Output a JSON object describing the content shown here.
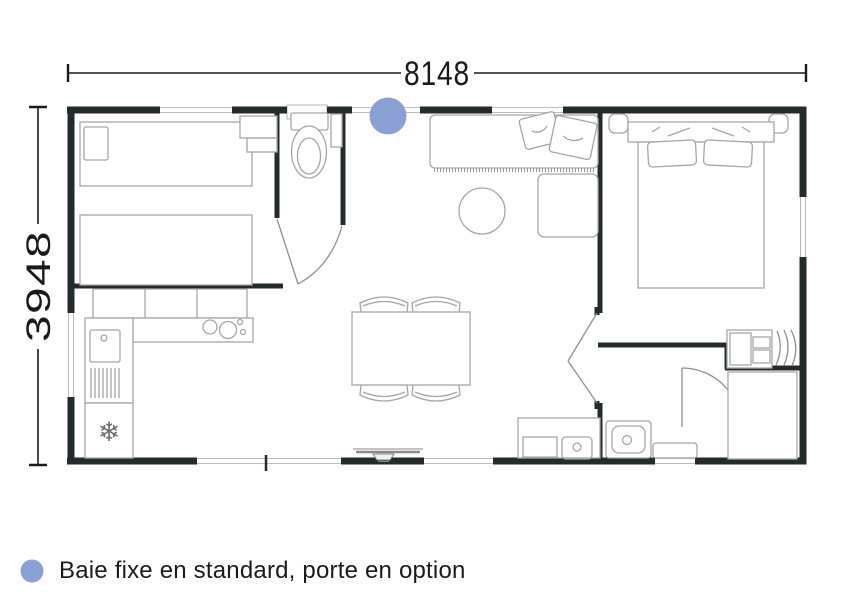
{
  "dimensions": {
    "width_label": "8148",
    "height_label": "3948"
  },
  "legend": {
    "marker_color": "#8AA0D4",
    "text": "Baie fixe en standard, porte en option"
  },
  "colors": {
    "wall": "#232B2D",
    "window_line": "#BCBCBC",
    "furniture": "#A6A6A6",
    "dimension": "#1A1A1A"
  },
  "icons": {
    "fridge": "❄"
  }
}
